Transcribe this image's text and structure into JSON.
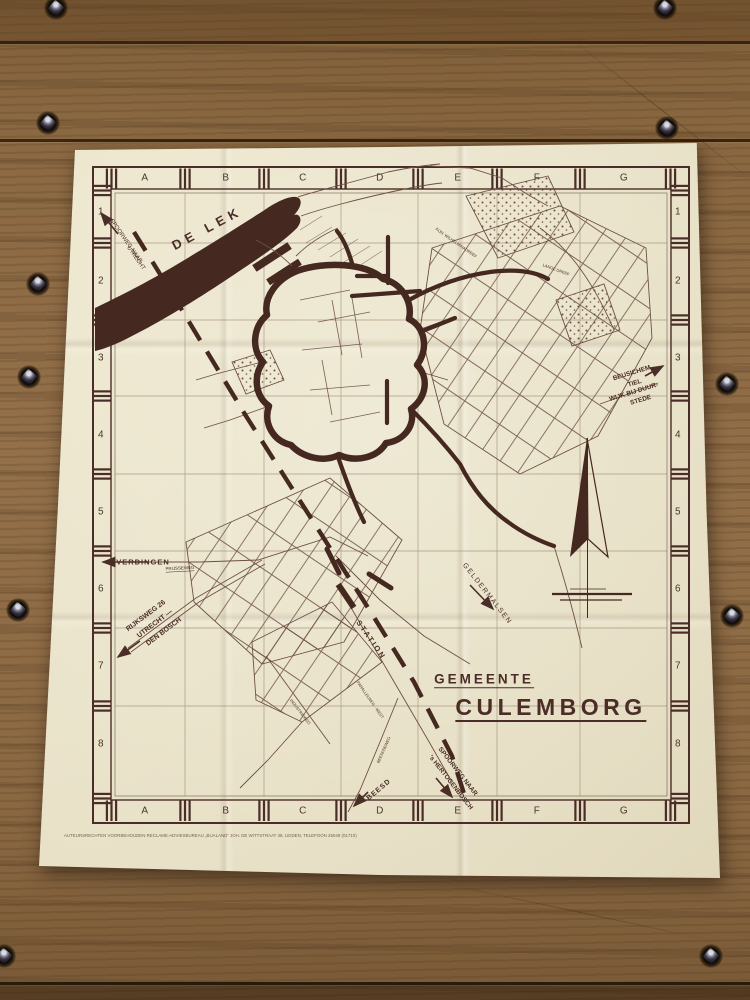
{
  "colors": {
    "ink": "#4a2d26",
    "ink_faint": "#6d5043",
    "paper": "#e8e1c7",
    "wood": "#8a6842"
  },
  "map": {
    "title": {
      "gemeente": "GEMEENTE",
      "culemborg": "CULEMBORG"
    },
    "grid": {
      "columns": [
        "A",
        "B",
        "C",
        "D",
        "E",
        "F",
        "G"
      ],
      "rows": [
        "1",
        "2",
        "3",
        "4",
        "5",
        "6",
        "7",
        "8"
      ]
    },
    "labels": {
      "de_lek": "DE LEK",
      "spoorweg_utrecht_1": "SPOORWEG NAAR",
      "spoorweg_utrecht_2": "UTRECHT",
      "steenovenslaan": "STEENOVENSLAAN",
      "everdingen": "EVERDINGEN",
      "prijsseweg": "PRIJSSEWEG",
      "rijksweg_1": "RIJKSWEG 26",
      "rijksweg_2": "UTRECHT —",
      "rijksweg_3": "DEN BOSCH",
      "station": "STATION",
      "geldermalsen": "GELDERMALSEN",
      "beusichem_1": "BEUSICHEM",
      "beusichem_2": "TIEL",
      "beusichem_3": "WIJK BIJ DUUR-",
      "beusichem_4": "STEDE",
      "spoorweg_den_bosch_1": "SPOORWEG NAAR",
      "spoorweg_den_bosch_2": "'s HERTOGENBOSCH",
      "beesd": "BEESD",
      "beesdseweg": "BEESDSEWEG",
      "parallelweg_west": "PARALLELWEG - WEST",
      "industrieweg": "INDUSTRIEWEG",
      "kon_wilhelminadreef": "KON. WILHELMINADREEF",
      "lange_dreef": "LANGE DREEF"
    },
    "credit_line": "AUTEURSRECHTEN VOORBEHOUDEN   RECLAME-ADVIESBUREAU „BUALAND”   JOH. DE WITTSTRAAT 38, LEIDEN, TELEFOON 25049 (01710)"
  }
}
